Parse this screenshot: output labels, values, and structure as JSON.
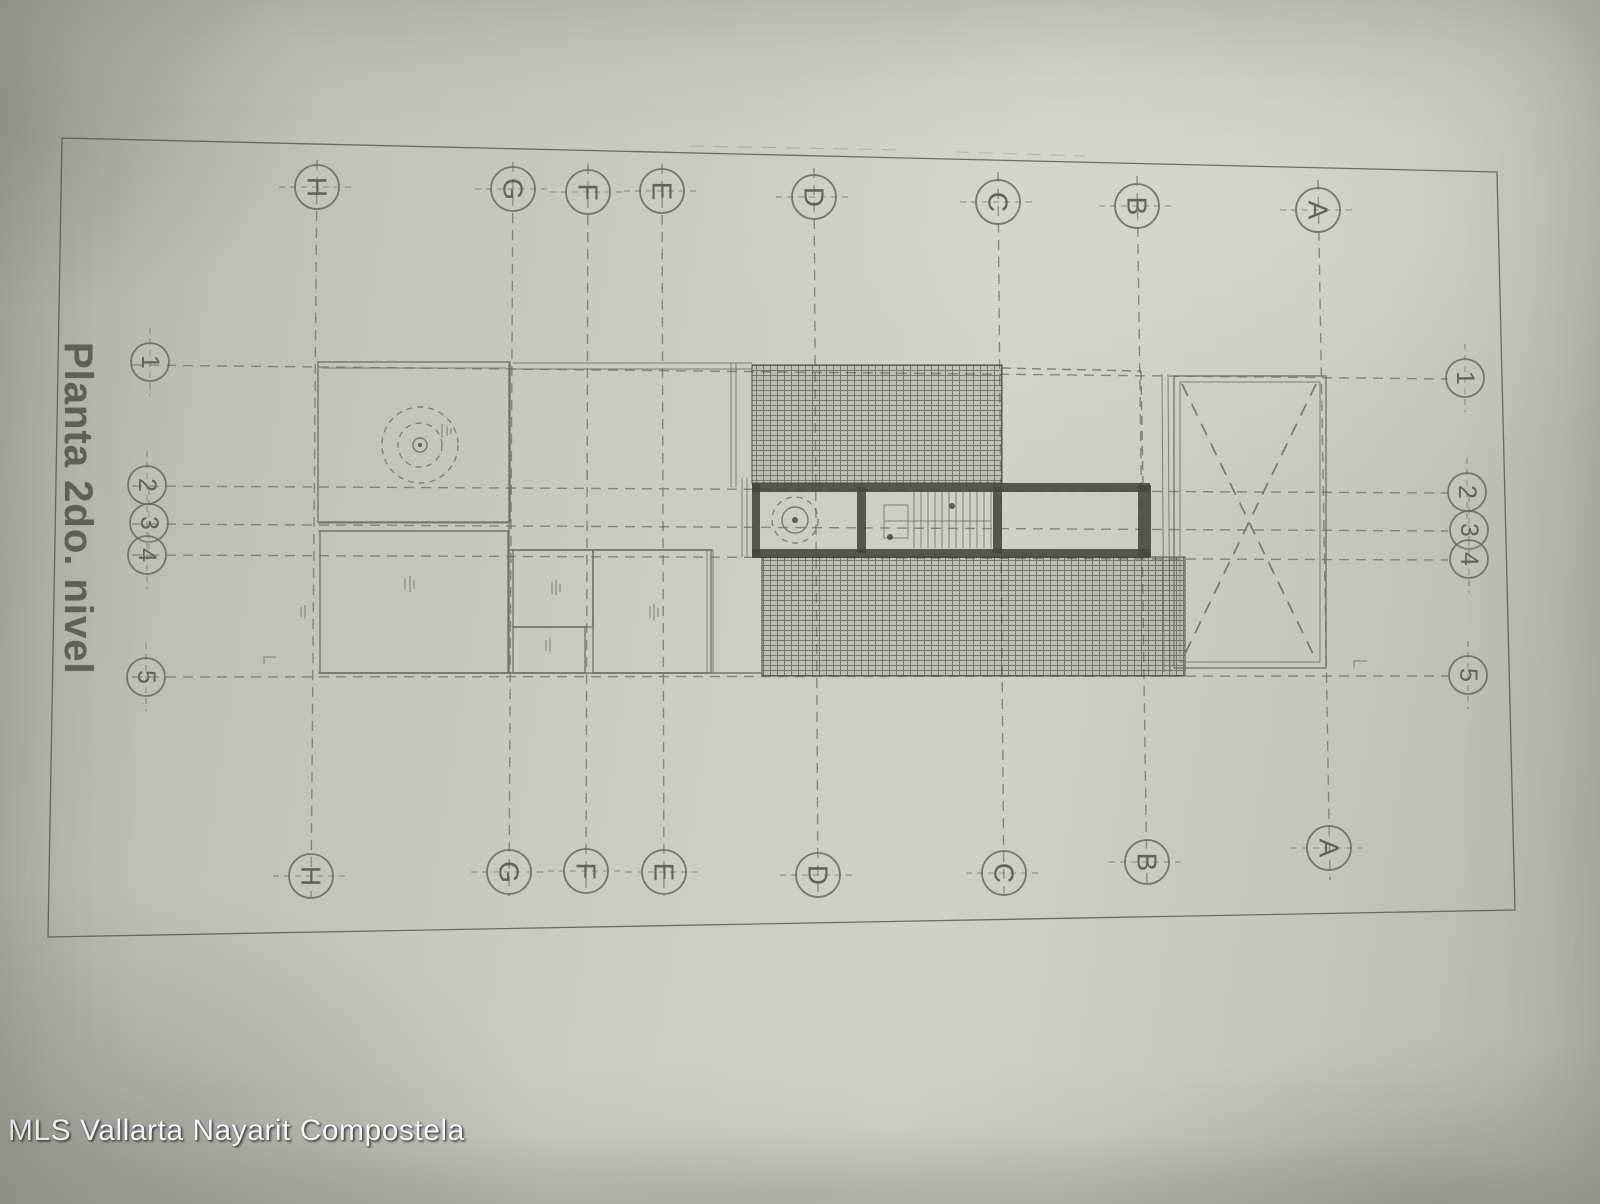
{
  "title": "Planta 2do. nivel",
  "watermark": "MLS Vallarta Nayarit Compostela",
  "grid": {
    "cols": [
      "H",
      "G",
      "F",
      "E",
      "D",
      "C",
      "B",
      "A"
    ],
    "rows": [
      "1",
      "2",
      "3",
      "4",
      "5"
    ]
  },
  "colors": {
    "paper": "#c9c6bf",
    "ink": "#6b695f",
    "wall": "#45443e",
    "watermark_text": "#ffffff"
  }
}
